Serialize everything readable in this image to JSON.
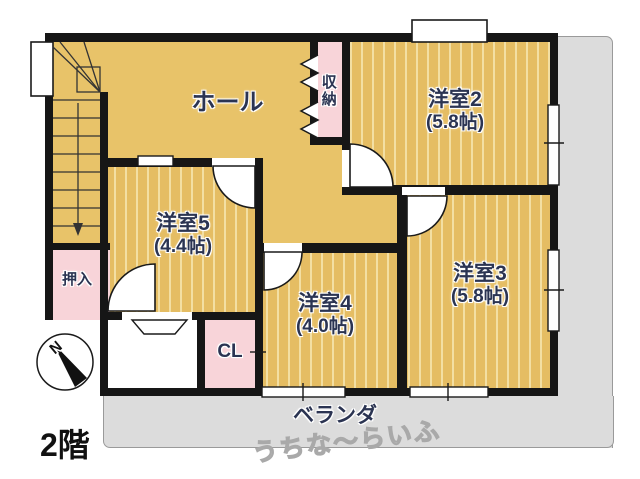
{
  "floor_label": "2階",
  "compass": {
    "north_label": "N"
  },
  "rooms": {
    "hall": {
      "label": "ホール"
    },
    "storage": {
      "label": "収納"
    },
    "room2": {
      "name": "洋室2",
      "size": "(5.8帖)"
    },
    "room3": {
      "name": "洋室3",
      "size": "(5.8帖)"
    },
    "room4": {
      "name": "洋室4",
      "size": "(4.0帖)"
    },
    "room5": {
      "name": "洋室5",
      "size": "(4.4帖)"
    },
    "oshiire": {
      "label": "押入"
    },
    "closet": {
      "label": "CL"
    },
    "veranda": {
      "label": "ベランダ"
    }
  },
  "watermark": "うちな〜らいふ",
  "colors": {
    "floor_tan": "#e6bf66",
    "floor_stripe": "#f3dfa3",
    "closet_pink": "#f8d4d9",
    "veranda_gray": "#dcdcdc",
    "wall_black": "#161616",
    "label_text": "#2b3452"
  }
}
